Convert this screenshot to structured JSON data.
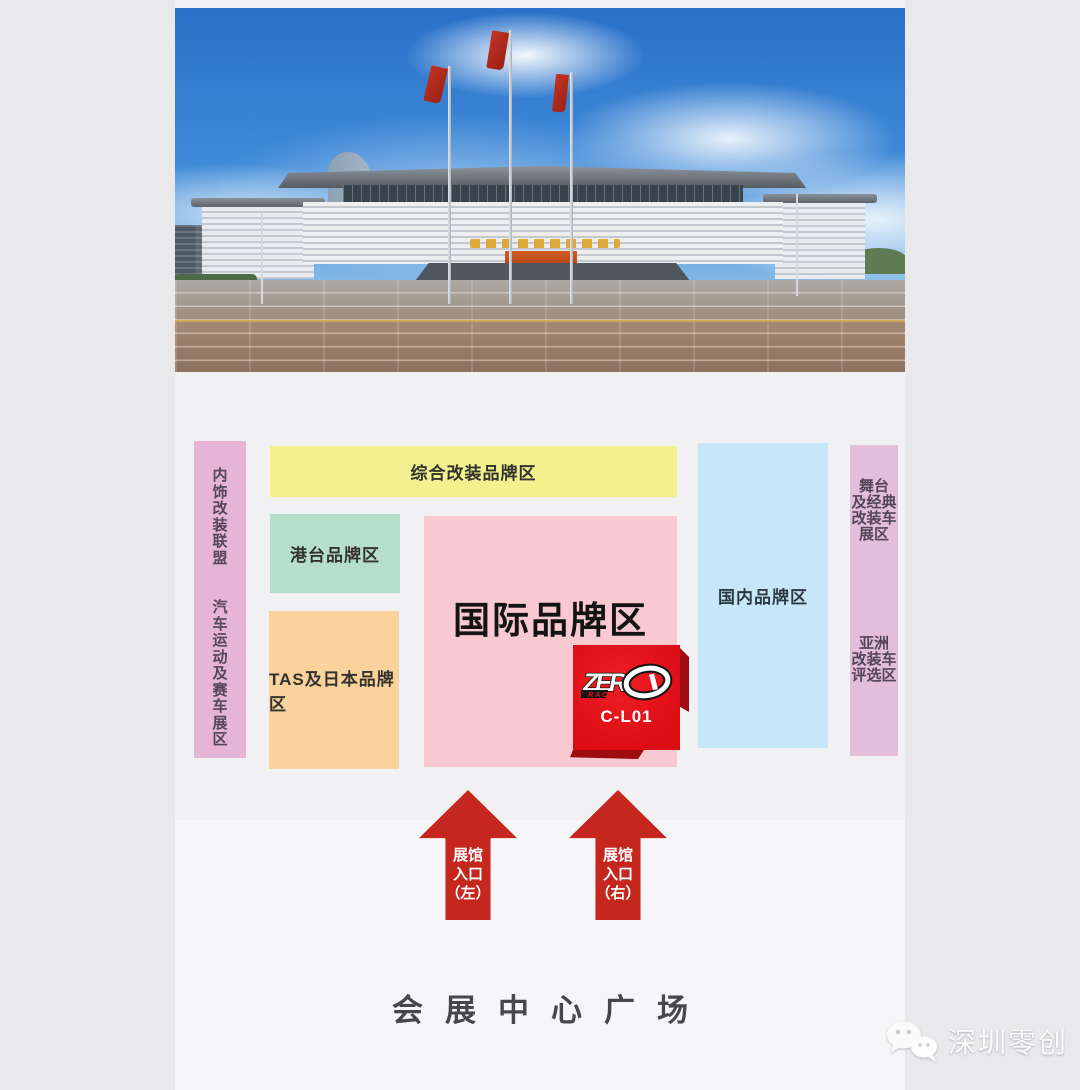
{
  "page": {
    "bg": "#e9e9eb",
    "column_bg": "#f1f1f3",
    "lower_bg": "#f6f6f8"
  },
  "map": {
    "left_strip": {
      "top_label": "内\n饰\n改\n装\n联\n盟",
      "bottom_label": "汽\n车\n运\n动\n及\n赛\n车\n展\n区",
      "color": "#e6b5d6"
    },
    "comprehensive_zone": {
      "label": "综合改装品牌区",
      "color": "#f2f08f"
    },
    "hktw_zone": {
      "label": "港台品牌区",
      "color": "#b5dfc8"
    },
    "tas_japan_zone": {
      "label": "TAS及日本品牌区",
      "color": "#fad29c"
    },
    "international_zone": {
      "label": "国际品牌区",
      "color": "#f9c9d1"
    },
    "domestic_zone": {
      "label": "国内品牌区",
      "color": "#c7e6f7"
    },
    "right_strip": {
      "top_label": "舞台\n及经典\n改装车\n展区",
      "bottom_label": "亚洲\n改装车\n评选区",
      "color": "#e3bedb"
    },
    "booth": {
      "logo_zer": "ZER",
      "logo_racing": "RACING",
      "code": "C-L01",
      "color": "#e5101b"
    },
    "entrance_left": {
      "label": "展馆\n入口\n（左）"
    },
    "entrance_right": {
      "label": "展馆\n入口\n（右）"
    },
    "arrow_color": "#c5271f"
  },
  "footer": {
    "plaza_label": "会展中心广场",
    "watermark_text": "深圳零创"
  }
}
